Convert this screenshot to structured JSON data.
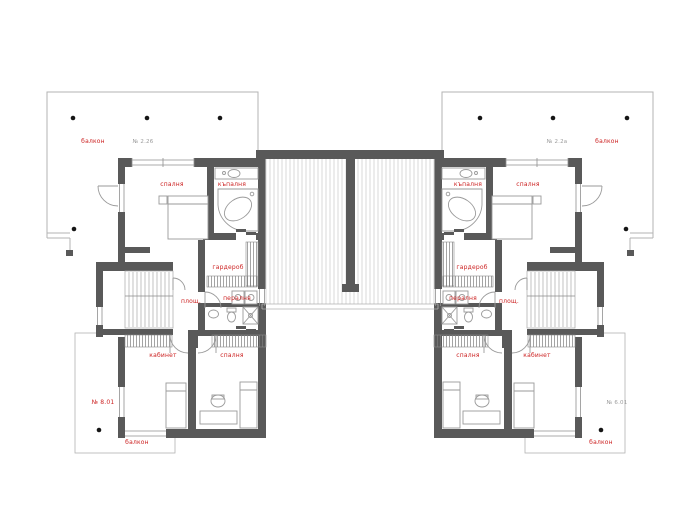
{
  "plan": {
    "labels": {
      "balcony": "балкон",
      "bedroom": "спалня",
      "bath": "къпалня",
      "wardrobe": "гардероб",
      "laundry": "пералня",
      "landing": "площ.",
      "office": "кабинет",
      "area_tl": "№ 2.26",
      "area_tr": "№ 2.2а",
      "area_bl": "№ 8.01",
      "area_br": "№ 6.01"
    },
    "colors": {
      "wall": "#595959",
      "red": "#cc2222",
      "grey": "#9b9b9b",
      "line": "#9a9a9a",
      "outline": "#b3b3b3",
      "hatch": "#d8d8d8"
    }
  }
}
